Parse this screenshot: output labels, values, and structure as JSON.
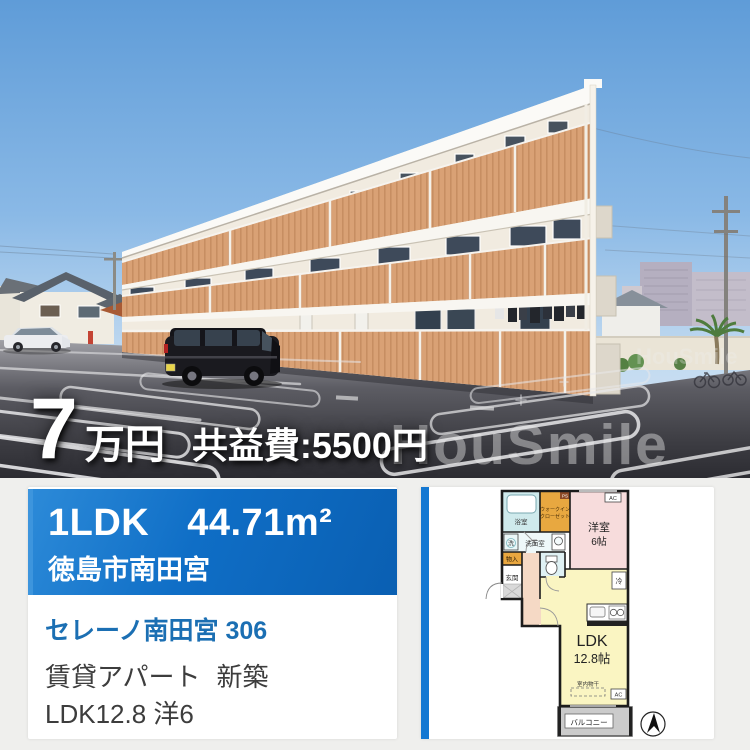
{
  "photo": {
    "price": {
      "amount": "7",
      "unit": "万円",
      "fee": "共益費:5500円"
    },
    "watermark": "HouSmile"
  },
  "listing": {
    "layout": "1LDK",
    "area": "44.71m²",
    "city": "徳島市南田宮",
    "name": "セレーノ南田宮 306",
    "category": "賃貸アパート",
    "condition": "新築",
    "rooms": "LDK12.8 洋6"
  },
  "floorplan": {
    "bath": "浴室",
    "wic_line1": "ウォークイン",
    "wic_line2": "クローゼット",
    "ps": "PS",
    "western": "洋室",
    "western_size": "6帖",
    "ac": "AC",
    "washer": "洗",
    "washroom": "洗面室",
    "storage": "物入",
    "entrance": "玄関",
    "fridge": "冷",
    "ldk": "LDK",
    "ldk_size": "12.8帖",
    "drying": "室内物干",
    "balcony": "バルコニー"
  },
  "colors": {
    "accent_blue": "#0f6ec6",
    "link_blue": "#1b6fb3",
    "band_orange": "#d9a175"
  }
}
